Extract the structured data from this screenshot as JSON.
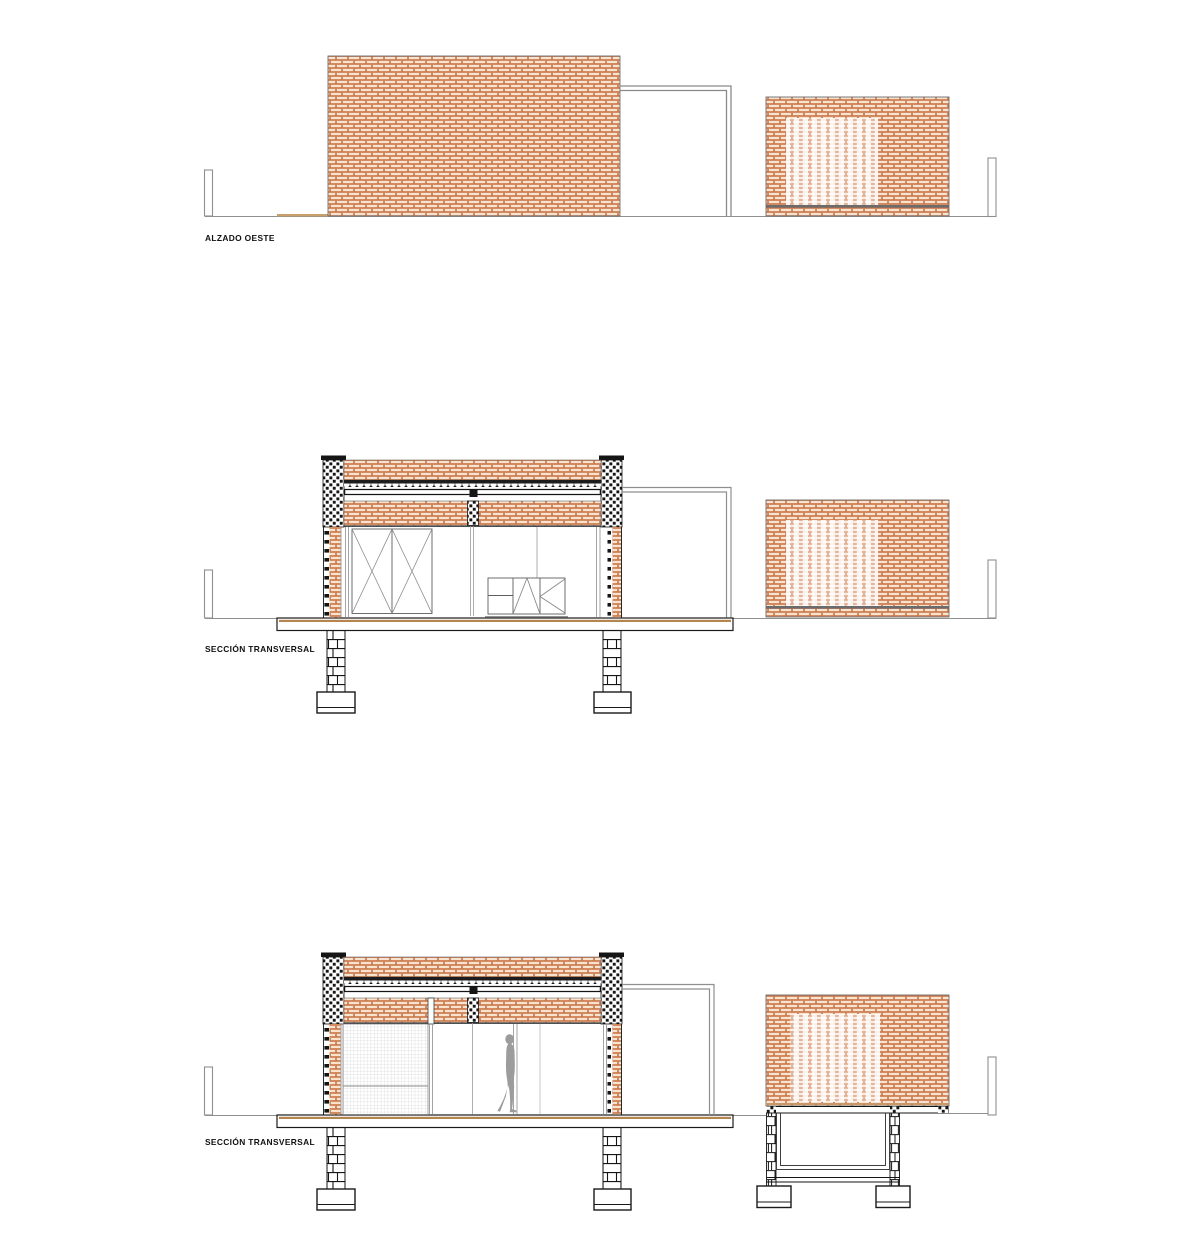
{
  "sheet": {
    "background": "#ffffff",
    "width_px": 1200,
    "height_px": 1252,
    "description": "Architectural drawing sheet with one elevation and two cross sections of a brick pavilion"
  },
  "drawings": [
    {
      "id": "alzado-oeste",
      "label": "ALZADO OESTE",
      "type": "elevation",
      "elements": [
        "large-brick-wall",
        "opening-frame",
        "brick-lattice-wall",
        "boundary-post-left",
        "boundary-post-right",
        "ground-line",
        "pavement-strip"
      ]
    },
    {
      "id": "seccion-transversal-1",
      "label": "SECCIÓN TRANSVERSAL",
      "type": "section",
      "elements": [
        "cut-masonry-columns",
        "parapet-brick-band",
        "corrugated-deck",
        "roof-beam",
        "x-braced-panels",
        "casework",
        "glazing-lines",
        "floor-slab",
        "foundation-piers",
        "footings",
        "pergola-frame",
        "brick-lattice-wall",
        "boundary-posts",
        "ground-line"
      ]
    },
    {
      "id": "seccion-transversal-2",
      "label": "SECCIÓN TRANSVERSAL",
      "type": "section",
      "elements": [
        "cut-masonry-columns",
        "parapet-brick-band",
        "corrugated-deck",
        "roof-beam",
        "mesh-screen",
        "human-figure",
        "glazing-lines",
        "floor-slab",
        "foundation-piers",
        "footings",
        "pergola-frame",
        "brick-lattice-wall",
        "water-tank",
        "boundary-posts",
        "ground-line"
      ]
    }
  ],
  "colors": {
    "brick_line": "#c4622d",
    "brick_fill": "#f6e3d0",
    "cut_masonry": "#151515",
    "line_black": "#1a1a1a",
    "line_gray": "#8f8f8f",
    "line_light_gray": "#9a9a9a",
    "slab_tan": "#b5854f",
    "pavement_tan": "#c9a06b",
    "mesh_gray": "#c2c2c2",
    "figure_gray": "#9c9c9c",
    "label_color": "#111111"
  }
}
